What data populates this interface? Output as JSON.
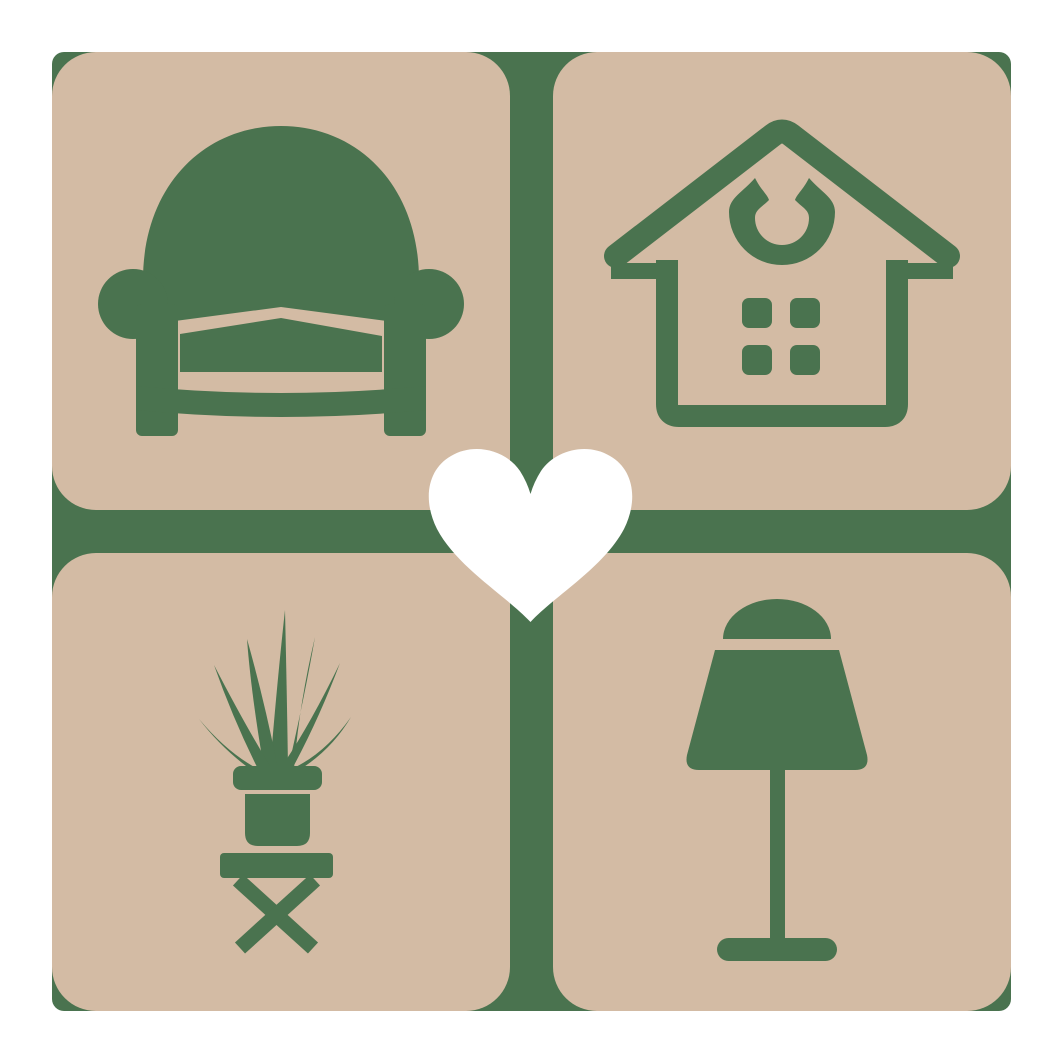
{
  "colors": {
    "background": "#ffffff",
    "tile": "#d3bba4",
    "icon_green": "#4a734f",
    "heart": "#ffffff"
  },
  "icons": {
    "top_left": "armchair",
    "top_right": "house",
    "bottom_left": "potted-plant",
    "bottom_right": "table-lamp",
    "center": "heart"
  }
}
